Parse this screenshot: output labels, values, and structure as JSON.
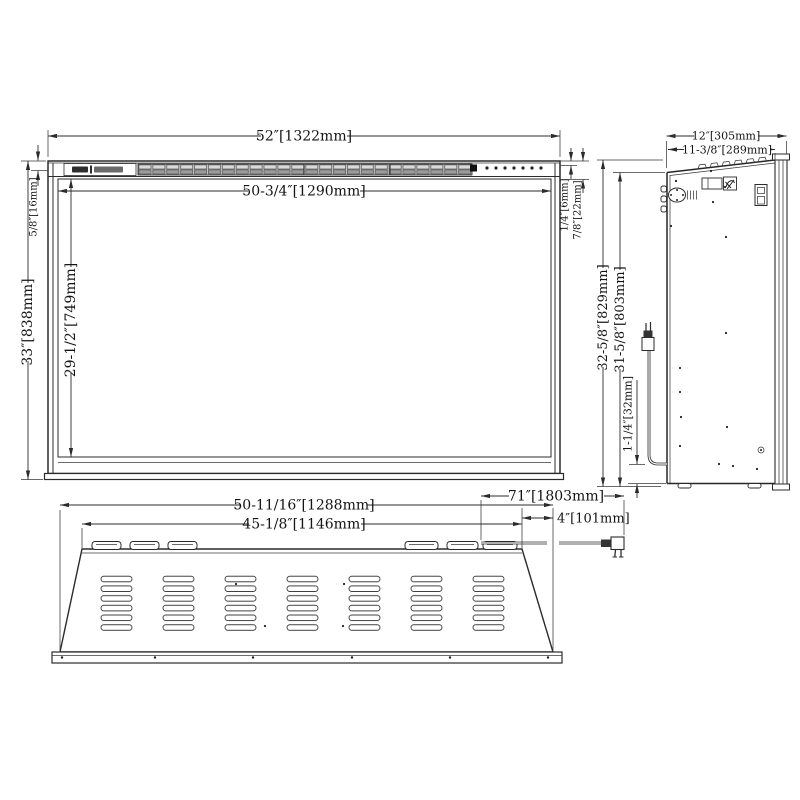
{
  "drawing": {
    "ink_color": "#2b2b2b",
    "background": "#ffffff",
    "grille_color": "#c4c4c4"
  },
  "views": {
    "front": {
      "dims": {
        "overall_width": "52″[1322mm]",
        "opening_width": "50-3/4″[1290mm]",
        "overall_height": "33″[838mm]",
        "opening_height": "29-1/2″[749mm]",
        "frame_top": "5/8″[16mm]",
        "glass_inset": "1/4″[6mm]",
        "frame_depth": "7/8″[22mm]"
      }
    },
    "side": {
      "dims": {
        "overall_depth": "12″[305mm]",
        "body_depth": "11-3/8″[289mm]",
        "overall_height": "32-5/8″[829mm]",
        "body_height": "31-5/8″[803mm]",
        "cord_exit_height": "1-1/4″[32mm]"
      }
    },
    "bottom": {
      "dims": {
        "body_width": "50-11/16″[1288mm]",
        "vent_width": "45-1/8″[1146mm]",
        "cord_length": "71″[1803mm]",
        "cord_offset": "4″[101mm]"
      }
    }
  }
}
